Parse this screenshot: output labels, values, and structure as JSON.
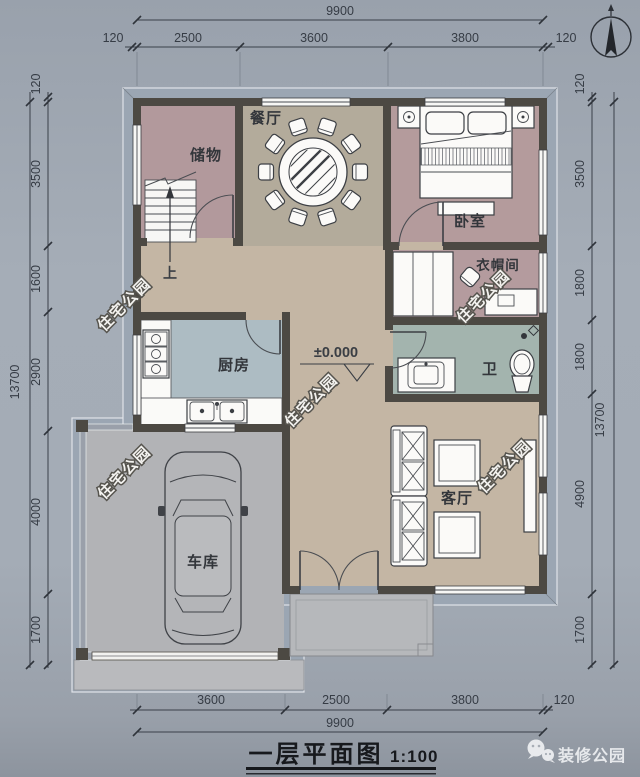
{
  "title": {
    "text": "一层平面图",
    "scale": "1:100"
  },
  "watermark": "住宅公园",
  "brand": "装修公园",
  "annotations": {
    "elevation": "±0.000",
    "stairs_up": "上"
  },
  "rooms": {
    "storage": "储物",
    "dining": "餐厅",
    "bedroom": "卧室",
    "cloakroom": "衣帽间",
    "kitchen": "厨房",
    "bathroom": "卫",
    "living": "客厅",
    "garage": "车库"
  },
  "dimensions": {
    "top_total": "9900",
    "top": [
      "120",
      "2500",
      "3600",
      "3800",
      "120"
    ],
    "bottom": [
      "3600",
      "2500",
      "3800",
      "120"
    ],
    "bottom_total": "9900",
    "left": [
      "120",
      "3500",
      "1600",
      "2900",
      "4000",
      "1700"
    ],
    "left_total": "13700",
    "right": [
      "120",
      "3500",
      "1800",
      "1800",
      "4900",
      "1700"
    ],
    "right_total": "13700"
  },
  "colors": {
    "background": "#a2aab4",
    "wall": "#4c4943",
    "floor_hall": "#c4b6a4",
    "floor_dining": "#b3ab9b",
    "floor_bedroom": "#b49b9c",
    "floor_kitchen": "#adbcc3",
    "floor_bath": "#a3b4ae",
    "floor_garage": "#b2b3b6",
    "eave": "#9ba6b3"
  }
}
